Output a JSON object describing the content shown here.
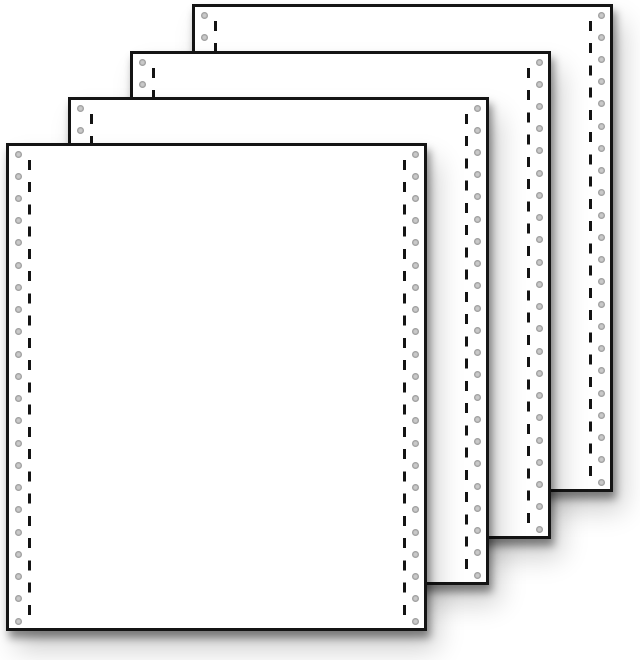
{
  "scene": {
    "description": "Stack of four blank fanfold continuous listing-paper sheets, staggered diagonally, each with tractor-feed sprocket-hole margins and dashed perforation lines, casting soft drop shadows on a white background",
    "background_color": "#ffffff",
    "sheet_count": 4,
    "paper": {
      "fill": "#ffffff",
      "border_color": "#141414",
      "border_width": 3,
      "width": 421,
      "height": 488
    },
    "sheets": [
      {
        "name": "sheet-4-back",
        "left": 192,
        "top": 4
      },
      {
        "name": "sheet-3",
        "left": 130,
        "top": 51
      },
      {
        "name": "sheet-2",
        "left": 68,
        "top": 97
      },
      {
        "name": "sheet-1-front",
        "left": 6,
        "top": 143
      }
    ],
    "margin": {
      "hole_count_per_column": 22,
      "hole_diameter": 7,
      "hole_spacing": 22.24,
      "hole_first_center_y": 11,
      "hole_center_from_edge": 12,
      "hole_color_ring": "#9b9b9b",
      "hole_color_center": "#c9c9c9",
      "perforation_center_from_edge": 23,
      "perforation_dash_width": 3,
      "perforation_dash_length": 10,
      "perforation_dash_period": 22.24,
      "perforation_color": "#141414",
      "perforation_top_inset": 14,
      "perforation_bottom_inset": 8
    },
    "shadow_color": "rgba(0,0,0,0.42)"
  }
}
